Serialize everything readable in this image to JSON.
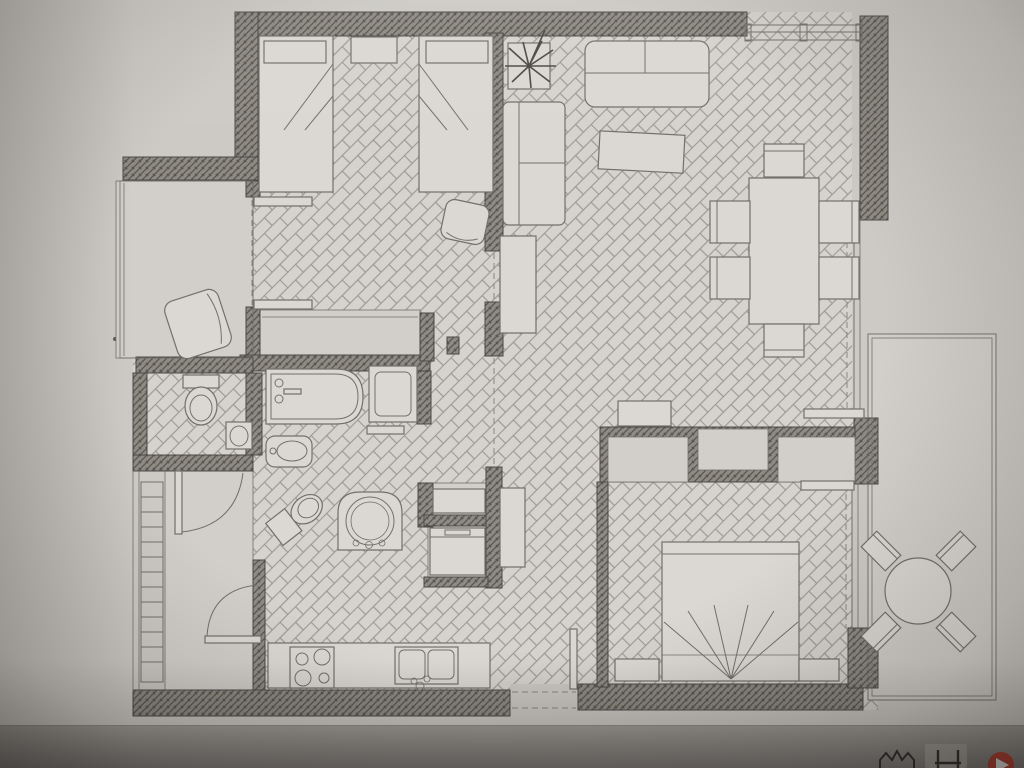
{
  "scene": {
    "kind": "photograph of a computer screen displaying a black-and-white architectural floor plan of an apartment",
    "drawing_style": "CAD top-down plan, hatched walls, herringbone parquet floors, no text labels"
  },
  "palette": {
    "photo_top": "#b2ada8",
    "photo_bottom": "#7d7a77",
    "paper": "#cdcac5",
    "floor": "#d6d3ce",
    "floor_plain": "#d2cfca",
    "wall_fill": "#8e8a84",
    "wall_hatch": "#5a564f",
    "line_dark": "#4c4a46",
    "line": "#73706c",
    "line_light": "#9d9992",
    "dash": "#8b8782",
    "furn": "#dbd8d3",
    "accent_red": "#b63c2d",
    "icon_dark": "#2f2e2c",
    "highlight_btn": "#a5a19c"
  },
  "floor_plan": {
    "rooms": [
      {
        "name": "bedroom-twin",
        "floor": "herringbone",
        "furniture": [
          "single bed x2",
          "nightstand",
          "desk chair",
          "built-in closet"
        ]
      },
      {
        "name": "balcony-left",
        "floor": "plain",
        "furniture": [
          "armchair"
        ]
      },
      {
        "name": "living-dining",
        "floor": "herringbone",
        "furniture": [
          "sofa",
          "loveseat",
          "tv bench",
          "tall cabinet",
          "potted plant",
          "dining table",
          "dining chair x6"
        ]
      },
      {
        "name": "wc",
        "floor": "herringbone",
        "furniture": [
          "toilet",
          "washbasin"
        ]
      },
      {
        "name": "bathroom",
        "floor": "herringbone",
        "furniture": [
          "bathtub",
          "shower tray",
          "bidet",
          "toilet",
          "vanity sink"
        ]
      },
      {
        "name": "utility-niche",
        "floor": "plain",
        "furniture": [
          "appliance x2"
        ]
      },
      {
        "name": "entry-hall",
        "floor": "plain",
        "furniture": [
          "swing door x2",
          "ladder-rack"
        ]
      },
      {
        "name": "kitchen",
        "floor": "herringbone",
        "furniture": [
          "counter",
          "4-burner hob",
          "double sink"
        ]
      },
      {
        "name": "hallway",
        "floor": "herringbone",
        "furniture": [
          "cabinet",
          "sideboard"
        ]
      },
      {
        "name": "master-bedroom",
        "floor": "herringbone",
        "furniture": [
          "double bed",
          "foot bench x2",
          "built-in wardrobe x2",
          "sliding door x2"
        ]
      },
      {
        "name": "terrace-right",
        "floor": "plain",
        "furniture": [
          "round table",
          "chair x4"
        ]
      }
    ]
  },
  "taskbar": {
    "icons": [
      {
        "name": "crown-icon"
      },
      {
        "name": "h-glyph-icon"
      },
      {
        "name": "red-play-icon"
      }
    ]
  }
}
